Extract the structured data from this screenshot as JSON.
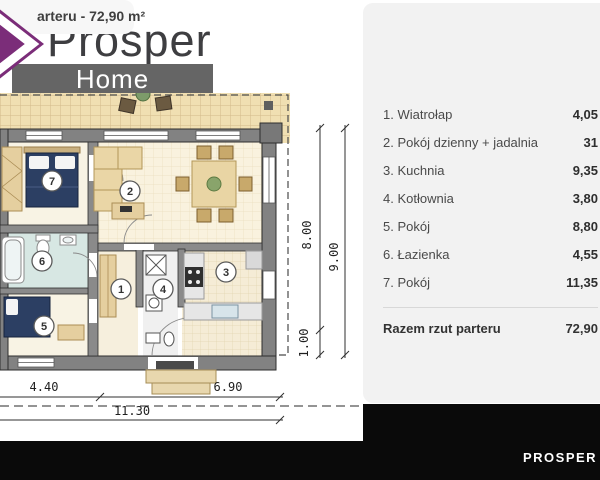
{
  "header": {
    "area_label": "arteru - 72,90 m²",
    "brand_top": "Prosper",
    "brand_bottom": "Home"
  },
  "legend": {
    "rooms": [
      {
        "label": "1. Wiatrołap",
        "value": "4,05"
      },
      {
        "label": "2. Pokój dzienny + jadalnia",
        "value": "31"
      },
      {
        "label": "3. Kuchnia",
        "value": "9,35"
      },
      {
        "label": "4. Kotłownia",
        "value": "3,80"
      },
      {
        "label": "5. Pokój",
        "value": "8,80"
      },
      {
        "label": "6. Łazienka",
        "value": "4,55"
      },
      {
        "label": "7. Pokój",
        "value": "11,35"
      }
    ],
    "total_label": "Razem rzut parteru",
    "total_value": "72,90"
  },
  "floorplan": {
    "circle_labels": {
      "c1": "1",
      "c2": "2",
      "c3": "3",
      "c4": "4",
      "c5": "5",
      "c6": "6",
      "c7": "7"
    },
    "dims": {
      "inner_height": "8.00",
      "total_height": "9.00",
      "eave_depth": "1.00",
      "width_left": "4.40",
      "width_right": "6.90",
      "width_total": "11.30"
    }
  },
  "footer": {
    "brand": "PROSPER HOME"
  },
  "colors": {
    "logo_purple": "#7b2d79",
    "bar_gray": "#656565",
    "panel_gray": "#f2f2f2",
    "footer_black": "#0a0a0a",
    "bed_navy": "#2c3f63",
    "furniture_beige": "#e9d5a4"
  }
}
